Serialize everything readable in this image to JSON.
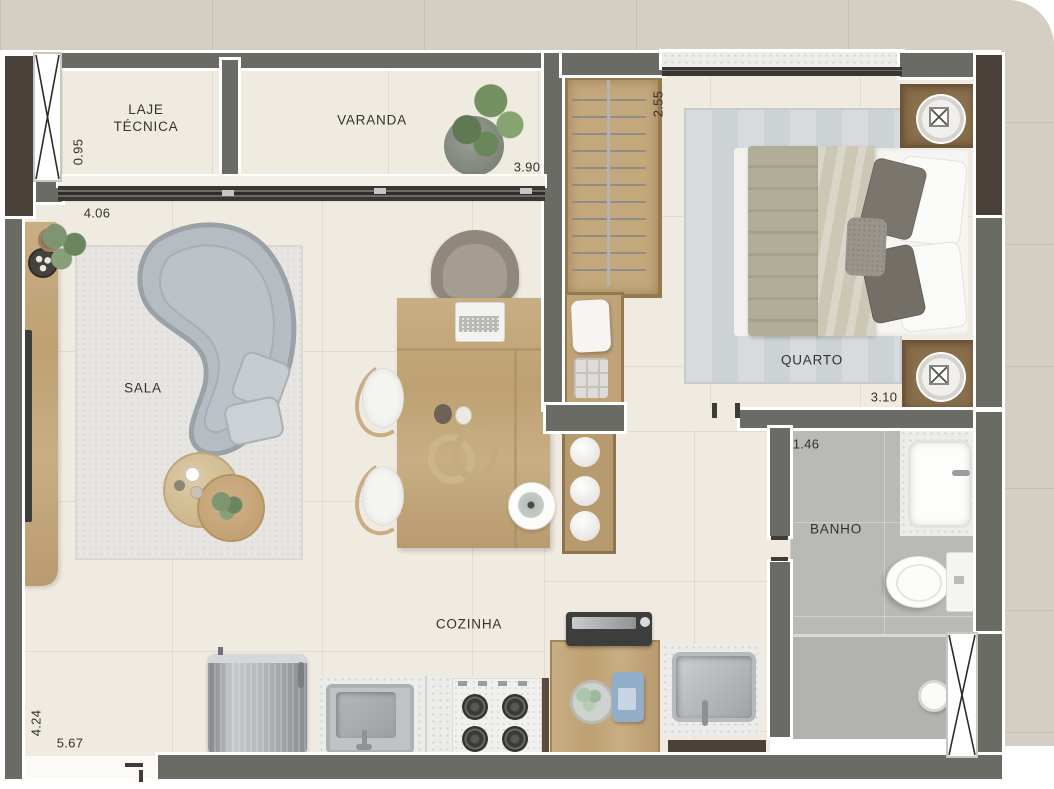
{
  "labels": {
    "laje_tecnica": "LAJE\nTÉCNICA",
    "varanda": "VARANDA",
    "quarto": "QUARTO",
    "sala": "SALA",
    "banho": "BANHO",
    "cozinha": "COZINHA"
  },
  "dimensions": {
    "laje_width": "0.95",
    "sala_width": "4.06",
    "varanda_width": "3.90",
    "closet_height": "2.55",
    "quarto_width": "3.10",
    "banho_width": "1.46",
    "sala_height": "4.24",
    "bottom_width": "5.67"
  },
  "colors": {
    "floor": "#f0ebe1",
    "walls": "#6b6b65",
    "dark_wall": "#494139",
    "facade": "#d5cec2",
    "wood": "#c3a87c",
    "sofa": "#b6bdc2",
    "bath_floor": "#b9b9b5",
    "rug": "#e6e5e1",
    "bed_blanket": "#afaa94",
    "counter_speckled": "#ececea",
    "detergent_blue": "#92aec8",
    "plant_green": "#7d9570",
    "label_text": "#34322f"
  },
  "furniture": [
    "curved-sofa",
    "sofa-pillows",
    "coffee-tables",
    "tv-console",
    "tv",
    "living-rug",
    "dining-table",
    "laptop",
    "desk-chair",
    "dining-chairs",
    "decor-wreath",
    "decor-vases",
    "decor-bowl",
    "shelf-with-bowls",
    "wardrobe-closet",
    "bench-with-pillow",
    "storage-boxes",
    "double-bed",
    "bed-pillows",
    "nightstands",
    "table-lamps",
    "bedroom-rug",
    "washbasin",
    "toilet",
    "shower-drain",
    "bathroom-window",
    "refrigerator",
    "kitchen-sink",
    "cooktop",
    "washing-machine",
    "laundry-cabinet",
    "laundry-sink",
    "detergent-bottle",
    "towel-bowl",
    "plants"
  ]
}
